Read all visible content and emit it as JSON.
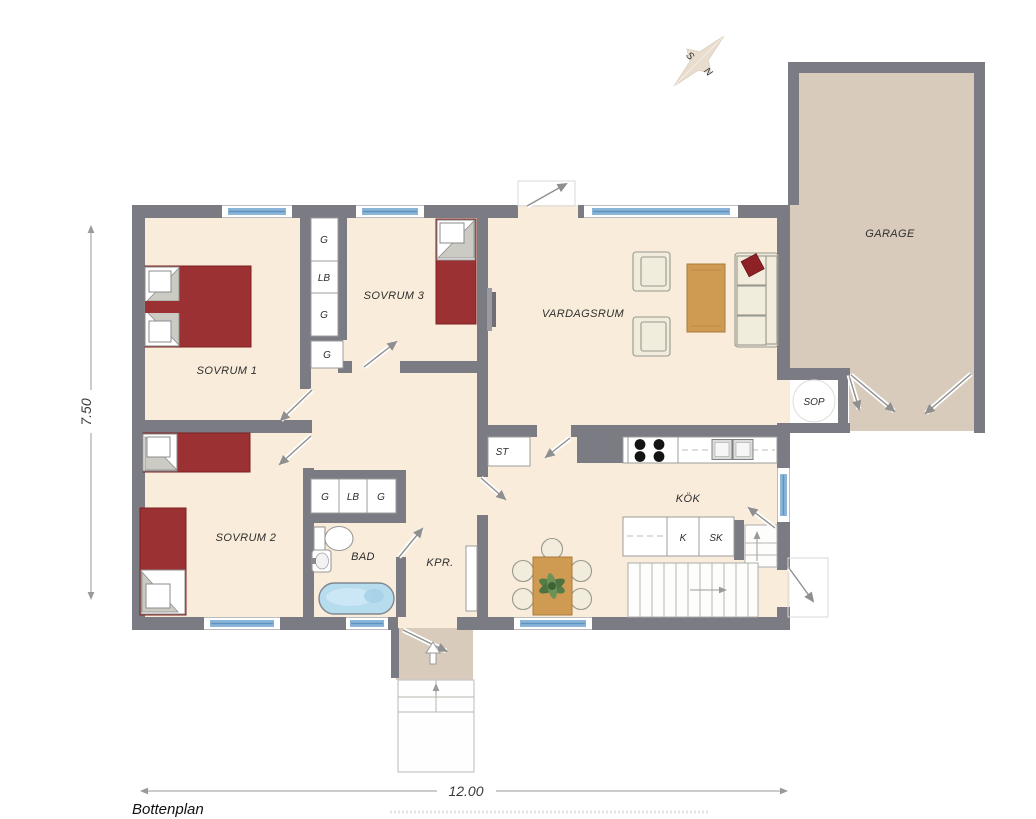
{
  "plan": {
    "title": "Bottenplan",
    "dimensions": {
      "width": "12.00",
      "depth": "7.50"
    },
    "compass": {
      "s": "S",
      "n": "N"
    },
    "rooms": {
      "bedroom1": "SOVRUM 1",
      "bedroom2": "SOVRUM 2",
      "bedroom3": "SOVRUM 3",
      "living": "VARDAGSRUM",
      "kitchen": "KÖK",
      "bath": "BAD",
      "hall": "KPR.",
      "garage": "GARAGE"
    },
    "closets": {
      "hall_column": [
        "G",
        "LB",
        "G"
      ],
      "hall_single": "G",
      "bath_row": [
        "G",
        "LB",
        "G"
      ],
      "cleaning": "ST"
    },
    "kitchen_units": {
      "k": "K",
      "sk": "SK"
    },
    "waste": "SOP",
    "colors": {
      "wall": "#7b7b83",
      "floor": "#f9ecda",
      "garage-floor": "#d8cbbc",
      "window-blue": "#8ab5d8",
      "window-blue-dark": "#5f93bd",
      "bed-red": "#9c3133",
      "wood": "#cf9a52",
      "sofa-cream": "#f2ecdc"
    }
  }
}
